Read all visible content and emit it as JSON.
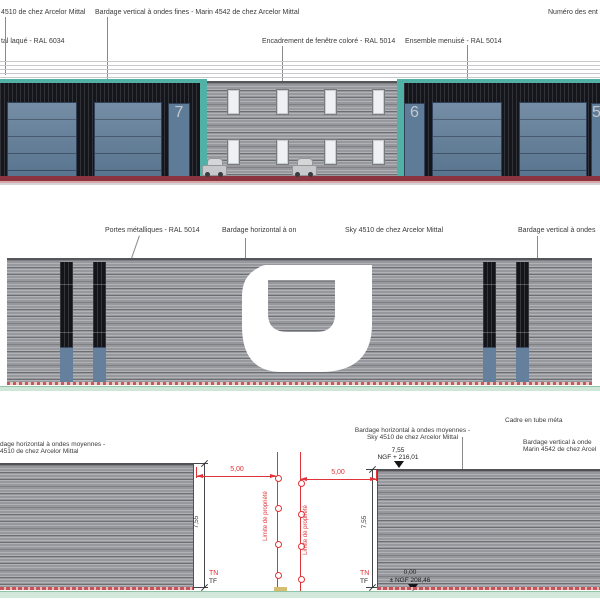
{
  "colors": {
    "teal_ral6034": "#52b1a6",
    "door_blue_ral5014": "#5e7b97",
    "dark_cladding": "#15161b",
    "gray_cladding": "#97989e",
    "base_red": "#8c3340",
    "dim_red": "#e03438",
    "ground_green": "#d2e8da"
  },
  "top": {
    "labels": {
      "frag_sky": "4510 de chez Arcelor Mittal",
      "bardage_vertical": "Bardage vertical à ondes fines - Marin 4542 de chez Arcelor Mittal",
      "numero": "Numéro des ent",
      "frag_laque": "tal laqué - RAL 6034",
      "encadrement": "Encadrement de fenêtre coloré - RAL 5014",
      "ensemble": "Ensemble menuisé - RAL 5014"
    },
    "units": {
      "u7": "7",
      "u6": "6",
      "u5": "5"
    }
  },
  "middle": {
    "labels": {
      "portes": "Portes métalliques - RAL 5014",
      "bardage_h_1": "Bardage horizontal à on",
      "bardage_h_2": "Sky 4510 de chez Arcelor Mittal",
      "bardage_v": "Bardage vertical à ondes"
    }
  },
  "bottom": {
    "labels": {
      "left_1": "dage horizontal à ondes moyennes -",
      "left_2": "4510 de chez Arcelor Mittal",
      "center_1": "Bardage horizontal à ondes moyennes -",
      "center_2": "Sky 4510 de chez Arcelor Mittal",
      "cadre": "Cadre en tube méta",
      "right_1": "Bardage vertical à onde",
      "right_2": "Marin 4542 de chez Arcel"
    },
    "levels": {
      "top_val": "7,55",
      "top_ngf": "NGF + 216,01",
      "zero_val": "0,00",
      "zero_ngf": "± NGF 208,46"
    },
    "dims": {
      "setback_left": "5,00",
      "setback_right": "5,00",
      "height_left": "7,55",
      "height_right": "7,55",
      "tn": "TN",
      "tf": "TF",
      "limite": "Limite de propriété"
    }
  }
}
